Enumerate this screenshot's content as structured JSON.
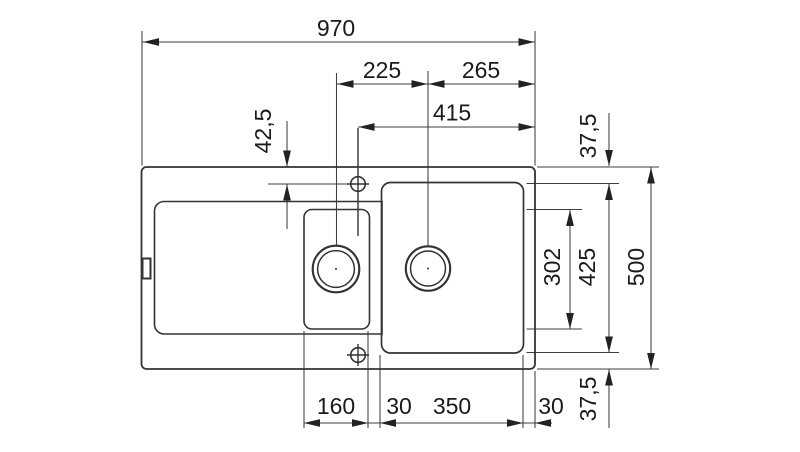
{
  "document": {
    "type": "technical-dimension-drawing",
    "subject": "kitchen sink with drainboard, small bowl and main bowl — top view",
    "units": "mm"
  },
  "colors": {
    "background": "#ffffff",
    "outline": "#333333",
    "dimension_line": "#3f3f3f",
    "arrow": "#222222",
    "text": "#1a1a1a"
  },
  "dims": {
    "width_overall": "970",
    "drain_spacing": "225",
    "drain_to_right_edge": "265",
    "tap_hole_to_right_edge": "415",
    "tap_hole_offset": "42,5",
    "top_rim": "37,5",
    "small_bowl_length": "302",
    "main_bowl_length": "425",
    "depth_overall": "500",
    "bottom_rim": "37,5",
    "small_bowl_width": "160",
    "divider_width": "30",
    "main_bowl_width": "350",
    "right_rim_width": "30"
  }
}
